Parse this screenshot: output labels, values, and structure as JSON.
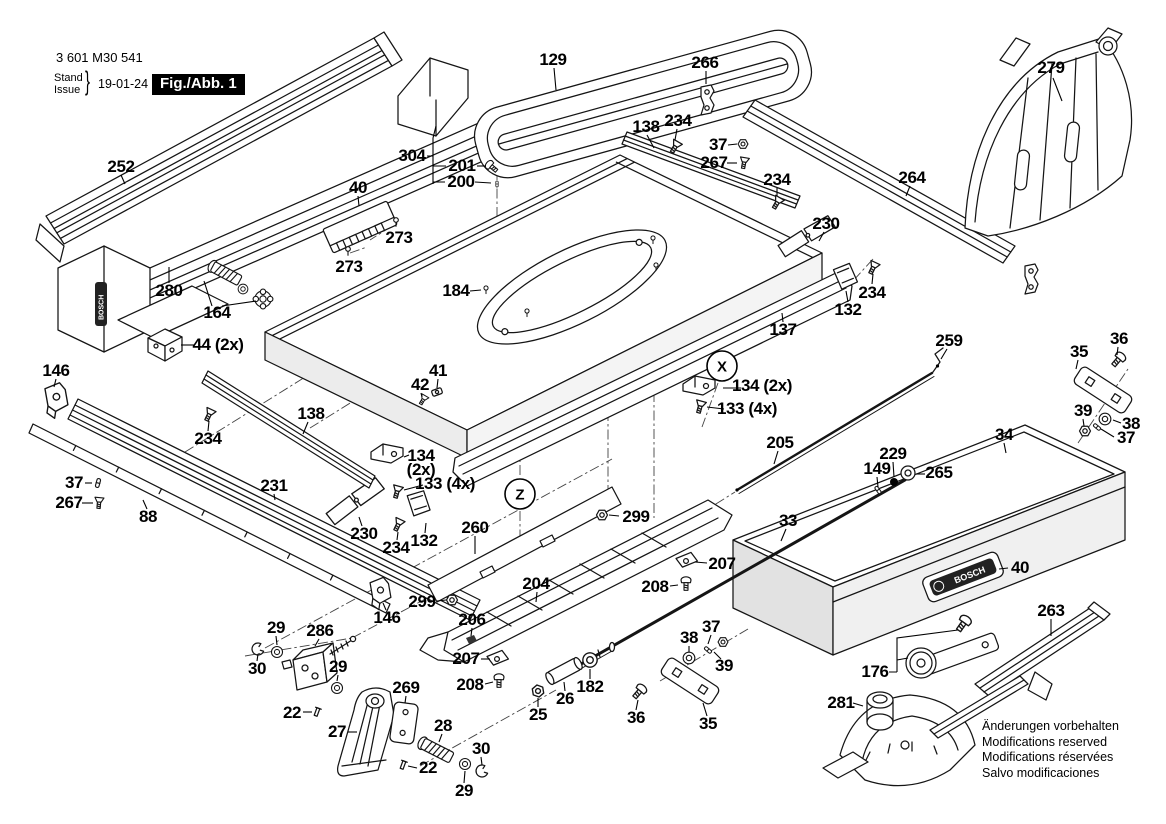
{
  "header": {
    "part_number": "3 601 M30 541",
    "revision": {
      "label_top": "Stand",
      "label_bottom": "Issue",
      "brace": "}",
      "date": "19-01-24"
    },
    "figure_label": "Fig./Abb. 1"
  },
  "brand": "BOSCH",
  "view_markers": [
    {
      "letter": "X"
    },
    {
      "letter": "Z"
    }
  ],
  "footer_notes": [
    "Änderungen vorbehalten",
    "Modifications reserved",
    "Modifications réservées",
    "Salvo modificaciones"
  ],
  "callouts": [
    {
      "t": "129",
      "x": 553,
      "y": 60
    },
    {
      "t": "266",
      "x": 705,
      "y": 63
    },
    {
      "t": "279",
      "x": 1051,
      "y": 68
    },
    {
      "t": "138",
      "x": 646,
      "y": 127
    },
    {
      "t": "234",
      "x": 678,
      "y": 121
    },
    {
      "t": "37",
      "x": 718,
      "y": 145
    },
    {
      "t": "267",
      "x": 714,
      "y": 163
    },
    {
      "t": "234",
      "x": 777,
      "y": 180
    },
    {
      "t": "264",
      "x": 912,
      "y": 178
    },
    {
      "t": "252",
      "x": 121,
      "y": 167
    },
    {
      "t": "304",
      "x": 412,
      "y": 156
    },
    {
      "t": "201",
      "x": 462,
      "y": 166
    },
    {
      "t": "200",
      "x": 461,
      "y": 182
    },
    {
      "t": "40",
      "x": 358,
      "y": 188
    },
    {
      "t": "273",
      "x": 399,
      "y": 238
    },
    {
      "t": "273",
      "x": 349,
      "y": 267
    },
    {
      "t": "280",
      "x": 169,
      "y": 291
    },
    {
      "t": "164",
      "x": 217,
      "y": 313
    },
    {
      "t": "44 (2x)",
      "x": 218,
      "y": 345
    },
    {
      "t": "184",
      "x": 456,
      "y": 291
    },
    {
      "t": "230",
      "x": 826,
      "y": 224
    },
    {
      "t": "234",
      "x": 872,
      "y": 293
    },
    {
      "t": "132",
      "x": 848,
      "y": 310
    },
    {
      "t": "137",
      "x": 783,
      "y": 330
    },
    {
      "t": "146",
      "x": 56,
      "y": 371
    },
    {
      "t": "138",
      "x": 311,
      "y": 414
    },
    {
      "t": "234",
      "x": 208,
      "y": 439
    },
    {
      "t": "41",
      "x": 438,
      "y": 371
    },
    {
      "t": "42",
      "x": 420,
      "y": 385
    },
    {
      "t": "36",
      "x": 1119,
      "y": 339
    },
    {
      "t": "35",
      "x": 1079,
      "y": 352
    },
    {
      "t": "259",
      "x": 949,
      "y": 341
    },
    {
      "t": "134 (2x)",
      "x": 762,
      "y": 386
    },
    {
      "t": "133 (4x)",
      "x": 747,
      "y": 409
    },
    {
      "t": "39",
      "x": 1083,
      "y": 411
    },
    {
      "t": "38",
      "x": 1131,
      "y": 424
    },
    {
      "t": "37",
      "x": 1126,
      "y": 438
    },
    {
      "t": "205",
      "x": 780,
      "y": 443
    },
    {
      "t": "34",
      "x": 1004,
      "y": 435
    },
    {
      "t": "229",
      "x": 893,
      "y": 454
    },
    {
      "t": "149",
      "x": 877,
      "y": 469
    },
    {
      "t": "265",
      "x": 939,
      "y": 473
    },
    {
      "t": "37",
      "x": 74,
      "y": 483
    },
    {
      "t": "267",
      "x": 69,
      "y": 503
    },
    {
      "t": "88",
      "x": 148,
      "y": 517
    },
    {
      "t": "231",
      "x": 274,
      "y": 486
    },
    {
      "t": "134",
      "x": 421,
      "y": 456
    },
    {
      "t": "(2x)",
      "x": 421,
      "y": 470
    },
    {
      "t": "133 (4x)",
      "x": 445,
      "y": 484
    },
    {
      "t": "230",
      "x": 364,
      "y": 534
    },
    {
      "t": "234",
      "x": 396,
      "y": 548
    },
    {
      "t": "132",
      "x": 424,
      "y": 541
    },
    {
      "t": "260",
      "x": 475,
      "y": 528
    },
    {
      "t": "299",
      "x": 636,
      "y": 517
    },
    {
      "t": "33",
      "x": 788,
      "y": 521
    },
    {
      "t": "204",
      "x": 536,
      "y": 584
    },
    {
      "t": "299",
      "x": 422,
      "y": 602
    },
    {
      "t": "146",
      "x": 387,
      "y": 618
    },
    {
      "t": "206",
      "x": 472,
      "y": 620
    },
    {
      "t": "207",
      "x": 466,
      "y": 659
    },
    {
      "t": "208",
      "x": 470,
      "y": 685
    },
    {
      "t": "207",
      "x": 722,
      "y": 564
    },
    {
      "t": "208",
      "x": 655,
      "y": 587
    },
    {
      "t": "29",
      "x": 276,
      "y": 628
    },
    {
      "t": "286",
      "x": 320,
      "y": 631
    },
    {
      "t": "30",
      "x": 257,
      "y": 669
    },
    {
      "t": "29",
      "x": 338,
      "y": 667
    },
    {
      "t": "22",
      "x": 292,
      "y": 713
    },
    {
      "t": "27",
      "x": 337,
      "y": 732
    },
    {
      "t": "269",
      "x": 406,
      "y": 688
    },
    {
      "t": "28",
      "x": 443,
      "y": 726
    },
    {
      "t": "30",
      "x": 481,
      "y": 749
    },
    {
      "t": "22",
      "x": 428,
      "y": 768
    },
    {
      "t": "29",
      "x": 464,
      "y": 791
    },
    {
      "t": "25",
      "x": 538,
      "y": 715
    },
    {
      "t": "26",
      "x": 565,
      "y": 699
    },
    {
      "t": "182",
      "x": 590,
      "y": 687
    },
    {
      "t": "36",
      "x": 636,
      "y": 718
    },
    {
      "t": "35",
      "x": 708,
      "y": 724
    },
    {
      "t": "38",
      "x": 689,
      "y": 638
    },
    {
      "t": "37",
      "x": 711,
      "y": 627
    },
    {
      "t": "39",
      "x": 724,
      "y": 666
    },
    {
      "t": "40",
      "x": 1020,
      "y": 568
    },
    {
      "t": "263",
      "x": 1051,
      "y": 611
    },
    {
      "t": "176",
      "x": 875,
      "y": 672
    },
    {
      "t": "281",
      "x": 841,
      "y": 703
    }
  ]
}
